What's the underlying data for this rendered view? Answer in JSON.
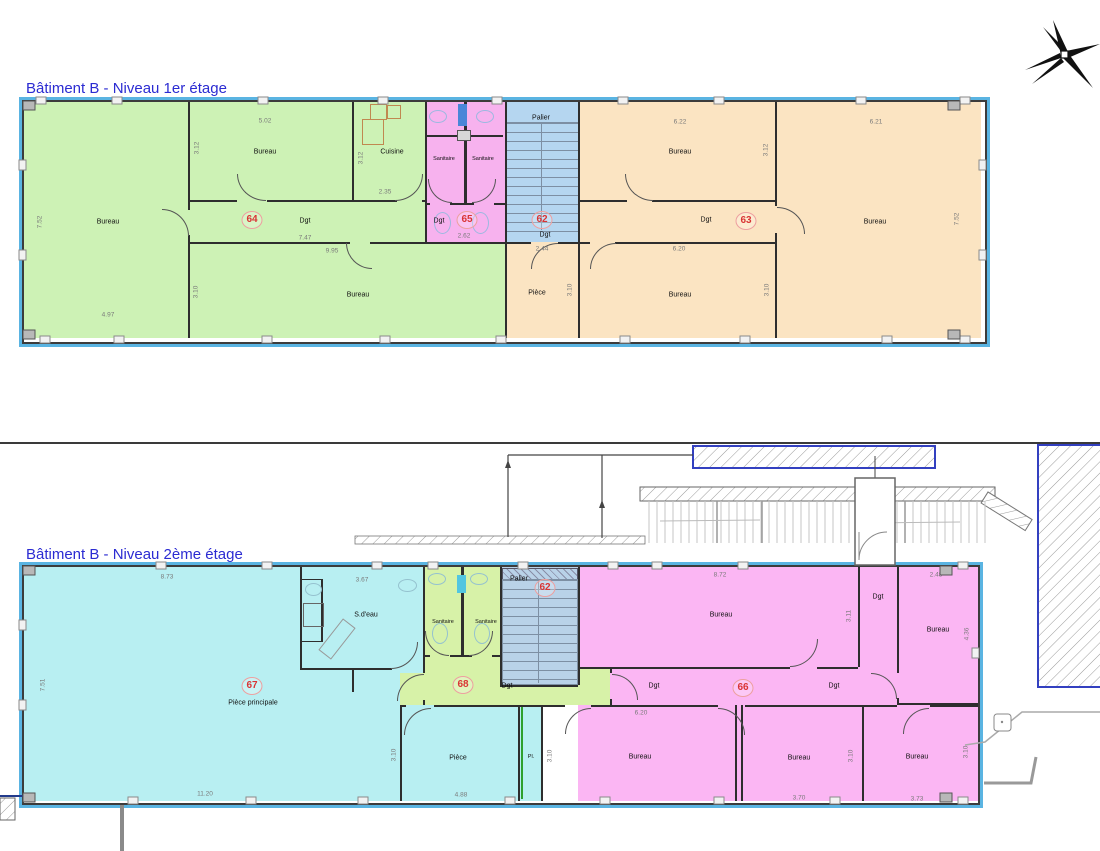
{
  "palette": {
    "green1": "#cdf2b5",
    "orange1": "#fbe4c2",
    "pink1": "#f7b2ee",
    "blue_palier1": "#b5d6f0",
    "cyan2": "#b8eff2",
    "pink2": "#fbb6f3",
    "green2": "#d7f2a8",
    "blue_palier2": "#b9d2e8",
    "perimeter_blue": "#5ab4e2",
    "title_blue": "#2b2bd2",
    "circle_red": "#d93434",
    "dim_gray": "#7a7a7a",
    "placard_green": "#2ea02e"
  },
  "icons": {
    "north_arrow": "north-star"
  },
  "plan1": {
    "title": "Bâtiment B - Niveau 1er étage",
    "rooms": {
      "bureau_left": {
        "label": "Bureau",
        "w": "4.97",
        "h": "7.52"
      },
      "bureau_a": {
        "label": "Bureau",
        "w": "5.02",
        "h": "3.12"
      },
      "cuisine": {
        "label": "Cuisine",
        "w": "2.35",
        "h": "3.12"
      },
      "sanitaire1": {
        "label": "Sanitaire"
      },
      "sanitaire2": {
        "label": "Sanitaire"
      },
      "palier": {
        "label": "Palier"
      },
      "bureau_b": {
        "label": "Bureau",
        "w": "6.22",
        "h": "3.12"
      },
      "bureau_right": {
        "label": "Bureau",
        "w": "6.21",
        "h": "7.52"
      },
      "bureau_c": {
        "label": "Bureau",
        "w": "9.95",
        "h": "3.10"
      },
      "piece": {
        "label": "Pièce",
        "h": "3.10"
      },
      "bureau_d": {
        "label": "Bureau",
        "w": "6.20",
        "h": "3.10"
      },
      "dgt64": {
        "label": "Dgt",
        "num": "64",
        "len": "7.47"
      },
      "dgt65": {
        "label": "Dgt",
        "num": "65",
        "len": "2.62"
      },
      "dgt62": {
        "label": "Dgt",
        "num": "62",
        "len": "2.44"
      },
      "dgt63": {
        "label": "Dgt",
        "num": "63"
      }
    }
  },
  "plan2": {
    "title": "Bâtiment B - Niveau 2ème étage",
    "rooms": {
      "piece_principale": {
        "label": "Pièce principale",
        "num": "67",
        "w": "11.20",
        "h": "7.51",
        "top": "8.73"
      },
      "sdeau": {
        "label": "S.d'eau",
        "w": "3.67"
      },
      "sanitaire1": {
        "label": "Sanitaire"
      },
      "sanitaire2": {
        "label": "Sanitaire"
      },
      "palier": {
        "label": "Palier",
        "num": "62"
      },
      "bureau_a": {
        "label": "Bureau",
        "w": "8.72",
        "h": "3.11"
      },
      "dgt_v": {
        "label": "Dgt"
      },
      "bureau_b": {
        "label": "Bureau",
        "w": "2.48",
        "h": "4.36"
      },
      "dgt68": {
        "label": "Dgt",
        "num": "68"
      },
      "dgt66l": {
        "label": "Dgt"
      },
      "dgt66": {
        "num": "66"
      },
      "dgt66r": {
        "label": "Dgt"
      },
      "piece": {
        "label": "Pièce",
        "w": "4.88",
        "h": "3.10"
      },
      "placard": {
        "label": "Pl."
      },
      "bureau_c": {
        "label": "Bureau",
        "w": "6.20",
        "h": "3.10"
      },
      "bureau_d": {
        "label": "Bureau",
        "w": "3.70",
        "h": "3.10"
      },
      "bureau_e": {
        "label": "Bureau",
        "w": "3.73",
        "h": "3.10"
      }
    }
  }
}
